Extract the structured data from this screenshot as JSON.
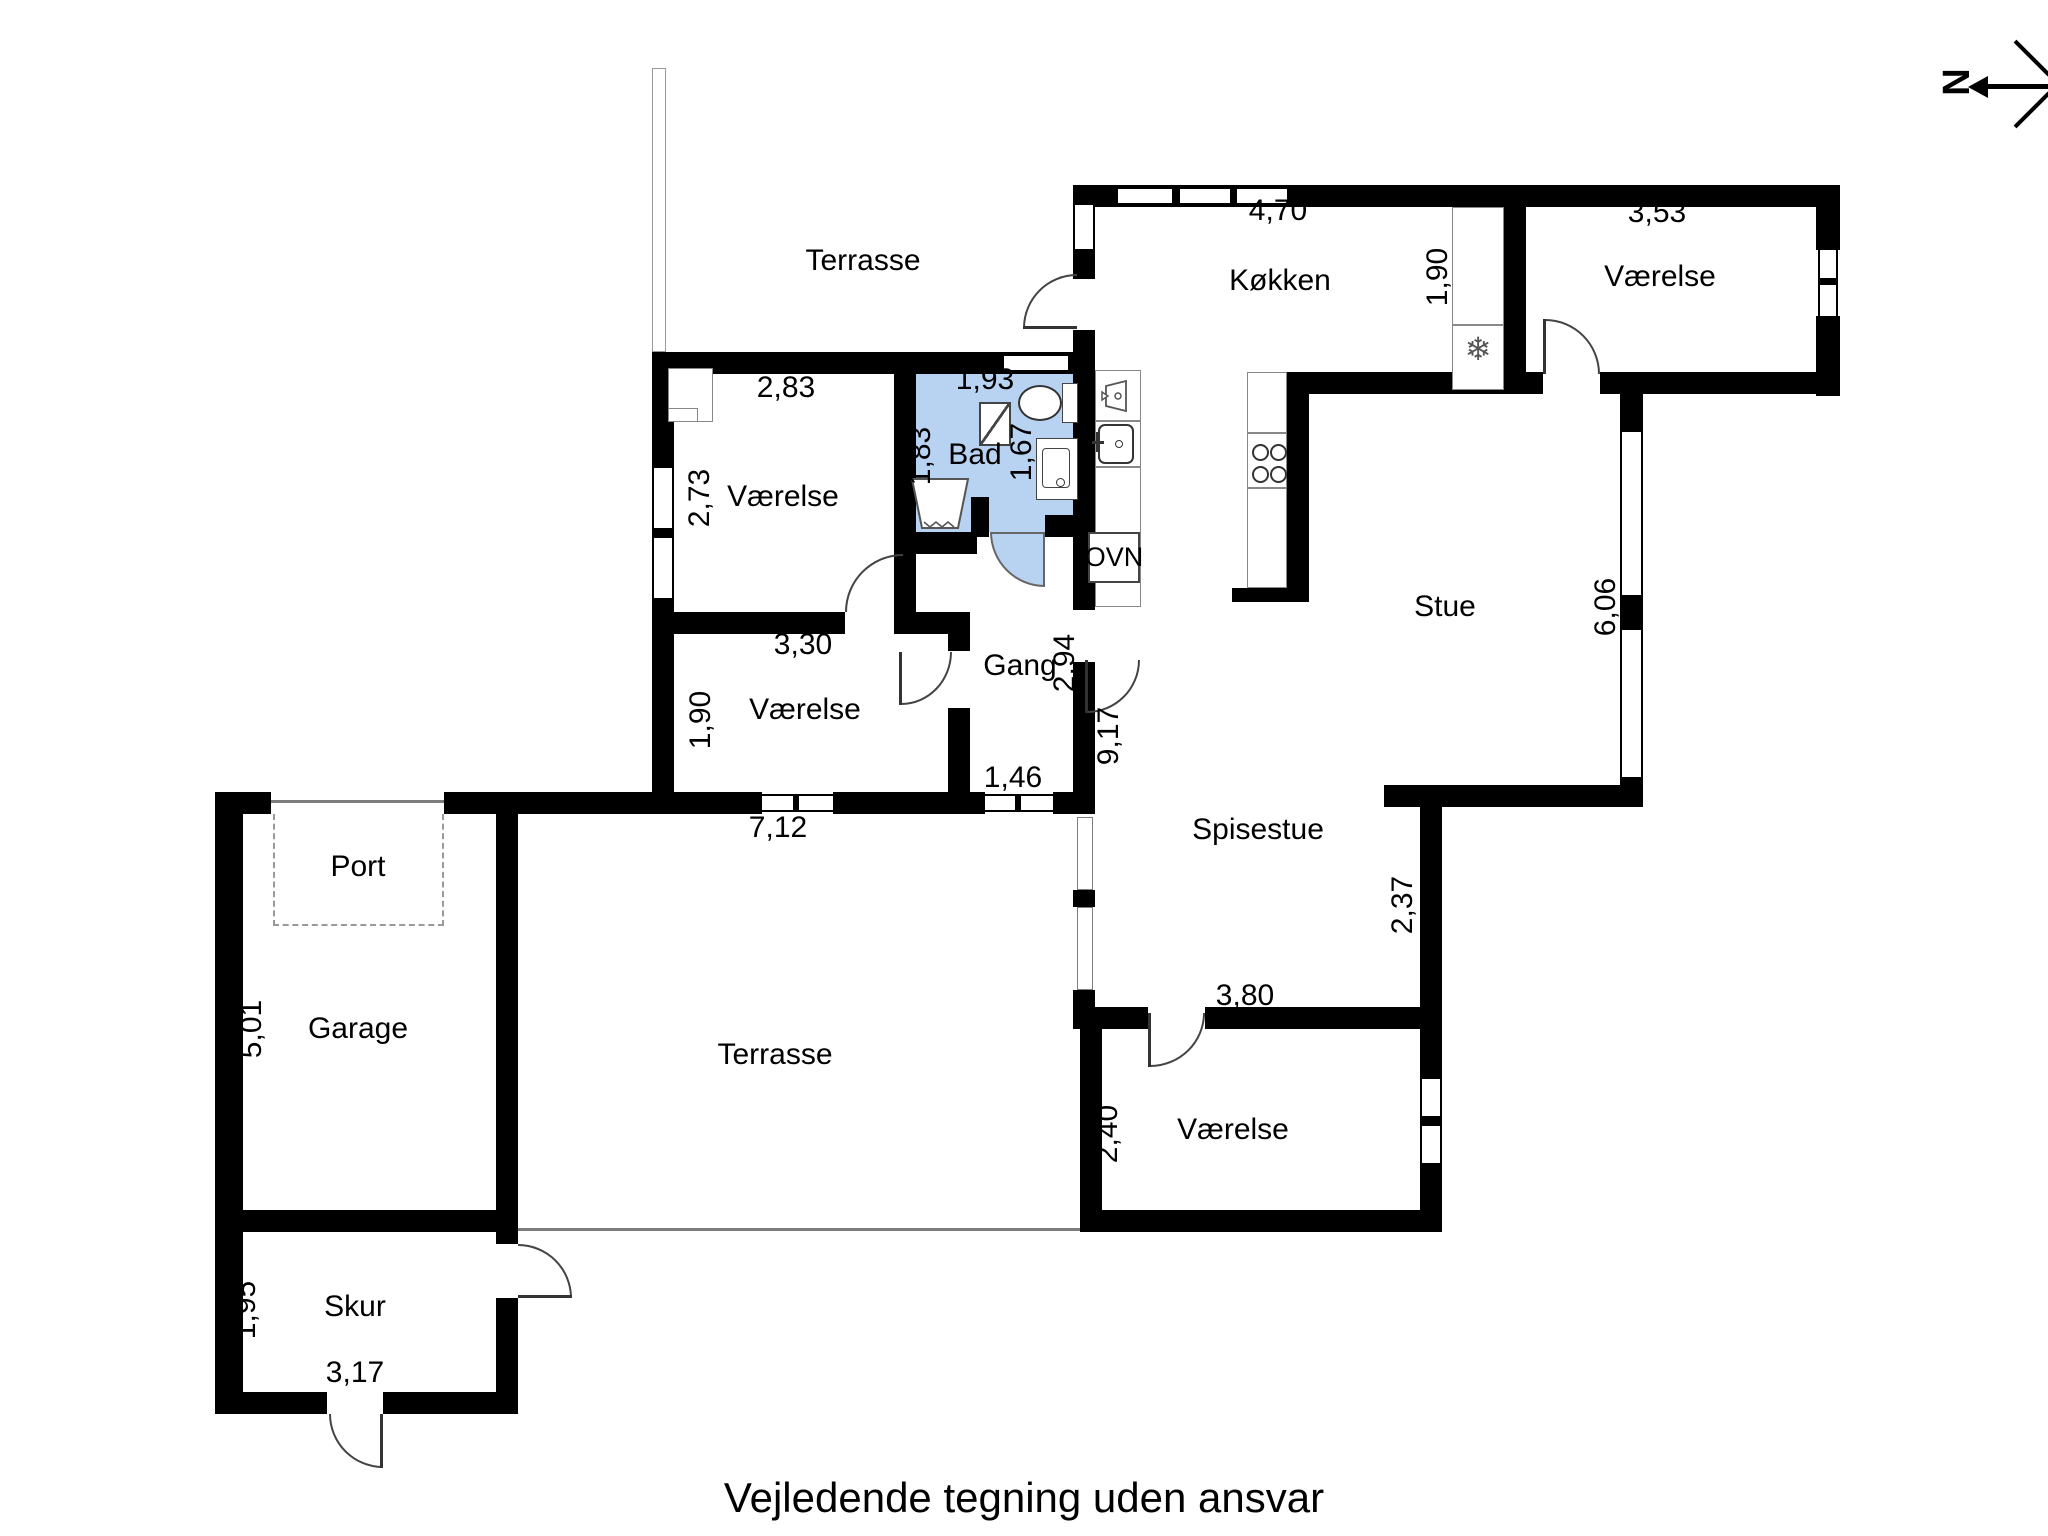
{
  "title": "Vejledende tegning uden ansvar",
  "north": {
    "label": "N"
  },
  "colors": {
    "wall": "#000000",
    "bath_fill": "#b8d2f2",
    "outline": "#7d7d7d"
  },
  "rooms": {
    "terrasse_top": {
      "label": "Terrasse"
    },
    "kokken": {
      "label": "Køkken",
      "width": "4,70",
      "depth": "1,90",
      "oven": "OVN"
    },
    "vaerelse_ne": {
      "label": "Værelse",
      "width": "3,53"
    },
    "bad": {
      "label": "Bad",
      "width": "1,93",
      "left": "1,83",
      "right": "1,67"
    },
    "vaerelse_nw": {
      "label": "Værelse",
      "width": "2,83",
      "depth": "2,73"
    },
    "vaerelse_w": {
      "label": "Værelse",
      "width": "3,30",
      "depth": "1,90"
    },
    "gang": {
      "label": "Gang",
      "depth": "2,94",
      "house_depth": "9,17",
      "window": "1,46"
    },
    "stue": {
      "label": "Stue",
      "window_height": "6,06"
    },
    "spisestue": {
      "label": "Spisestue",
      "depth": "2,37",
      "width": "3,80"
    },
    "vaerelse_s": {
      "label": "Værelse",
      "depth": "2,40"
    },
    "terrasse_s": {
      "label": "Terrasse",
      "wall_width": "7,12"
    },
    "garage": {
      "label": "Garage",
      "depth": "5,01",
      "port": "Port"
    },
    "skur": {
      "label": "Skur",
      "depth": "1,95",
      "width": "3,17"
    }
  },
  "icons": {
    "fridge_glyph": "❄"
  }
}
